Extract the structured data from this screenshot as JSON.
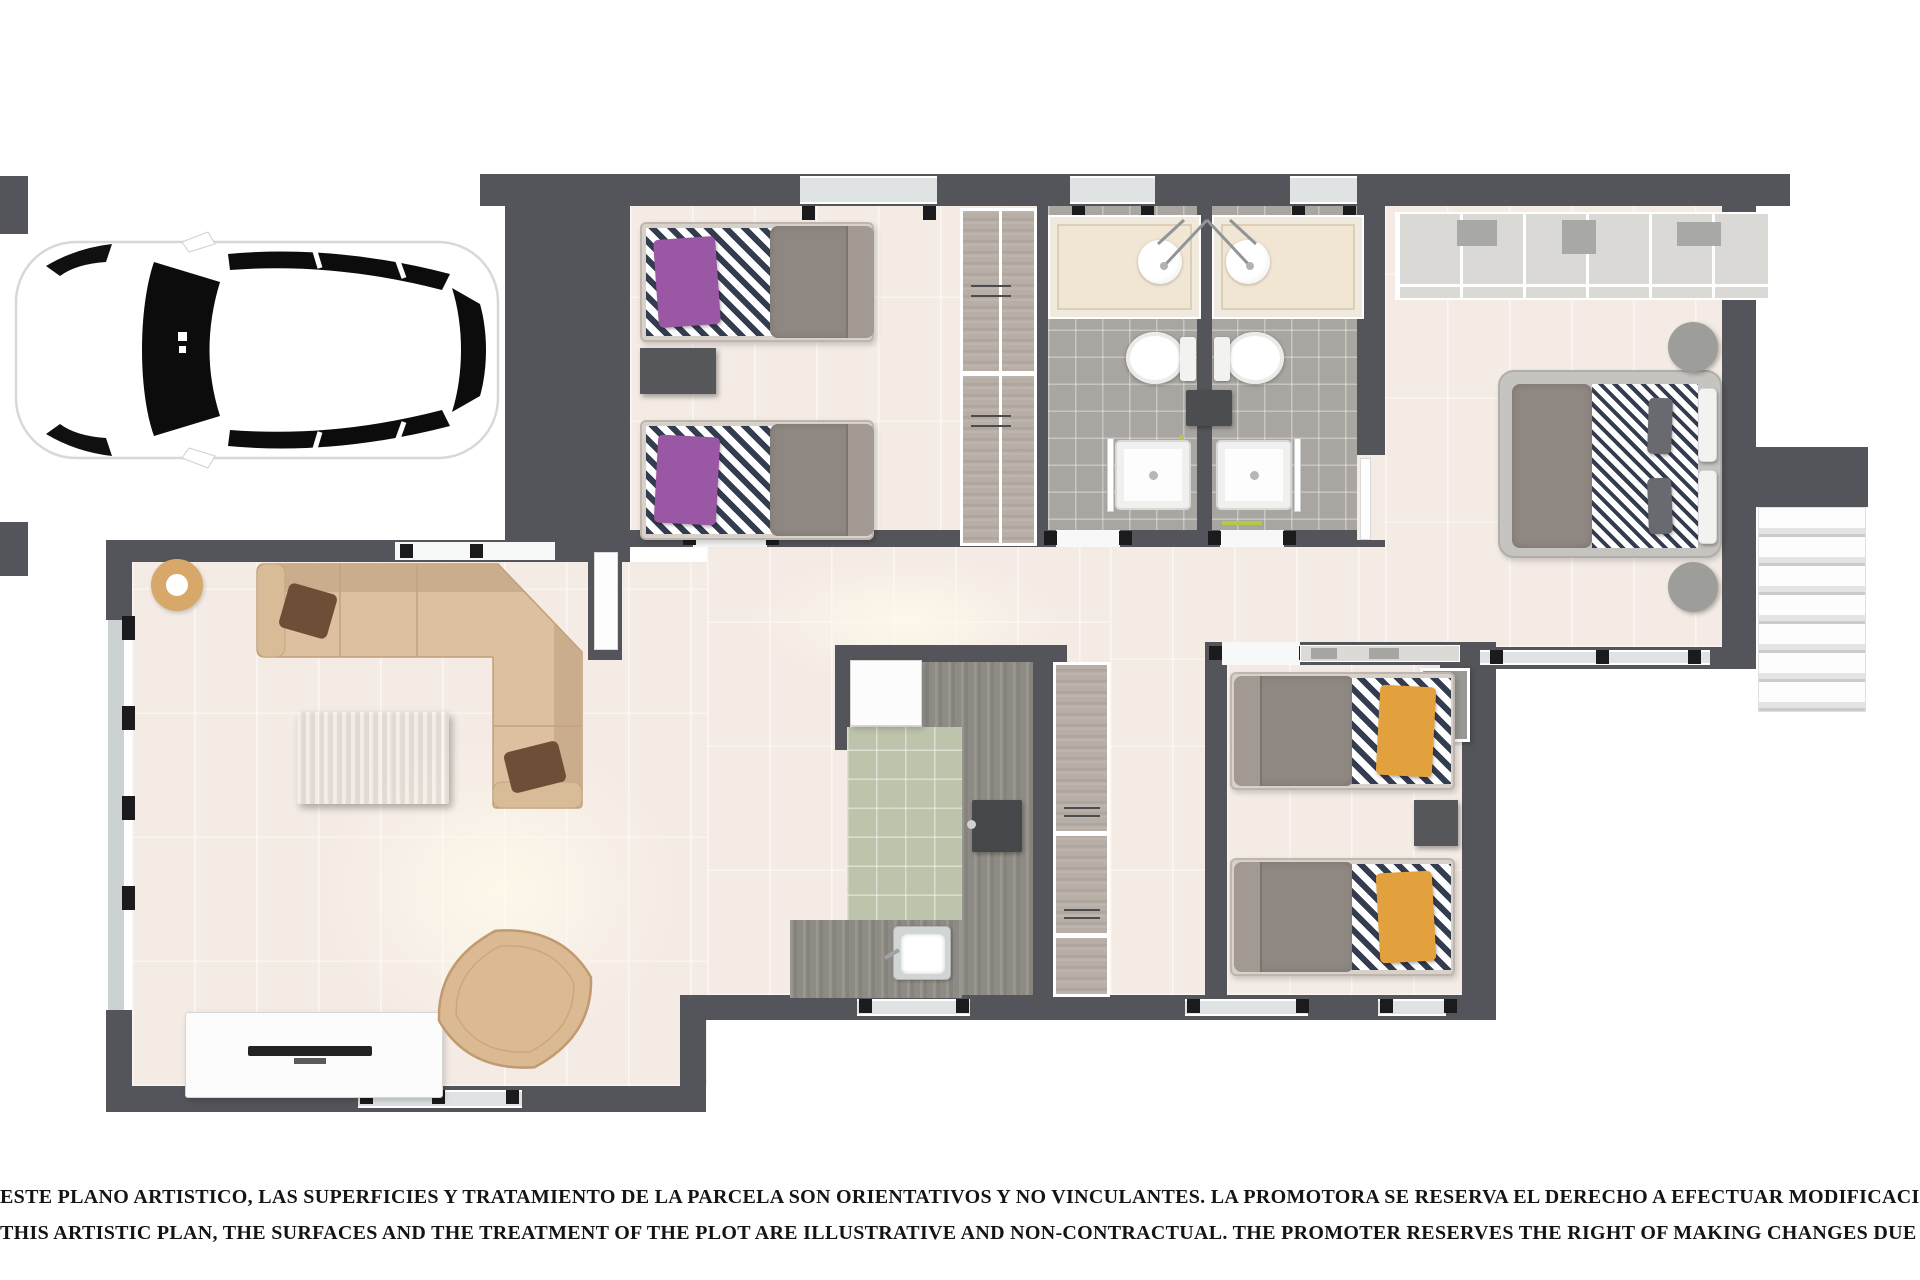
{
  "disclaimer": {
    "line1": "ESTE PLANO ARTISTICO, LAS SUPERFICIES Y TRATAMIENTO DE LA PARCELA SON ORIENTATIVOS Y NO VINCULANTES. LA PROMOTORA SE RESERVA EL DERECHO A EFECTUAR MODIFICACIONES POR CUALQUIER NECESIDAD",
    "line2": "THIS ARTISTIC PLAN, THE SURFACES AND THE TREATMENT OF THE PLOT ARE ILLUSTRATIVE AND NON-CONTRACTUAL. THE PROMOTER RESERVES THE RIGHT OF MAKING CHANGES DUE TO ANY NECESSITY"
  },
  "palette": {
    "wall": "#54555a",
    "floor": "#f4ebe5",
    "floor-bath": "#a9a6a1",
    "floor-kitchen": "#bdc4ac",
    "wood": "#8e8b85",
    "closet": "#b7aea6",
    "sofa": "#dcc0a0",
    "sofa-dark": "#c9ad8d",
    "duvet": "#8f8781",
    "mattress": "#d8d1ca",
    "purple": "#9a57a3",
    "yellow": "#e2a13c",
    "navy": "#343c50",
    "lime": "#b6c945",
    "tan": "#d8a86b",
    "tick": "#1b1b1d"
  },
  "legend": {
    "car": "white car seen from above on driveway",
    "bedroom-twin": "bedroom with two single beds, purple pillows",
    "bathrooms": "two bathrooms with vanities, sinks, toilets and showers",
    "master-bedroom": "master bedroom with double bed and wardrobe wall",
    "bedroom-2": "bedroom with two single beds, yellow pillows",
    "living-room": "living room with corner sofa, coffee table, TV unit and lounge chair",
    "kitchen": "kitchen with green floor, counters, sink and hob",
    "stairs": "external staircase at right side"
  }
}
